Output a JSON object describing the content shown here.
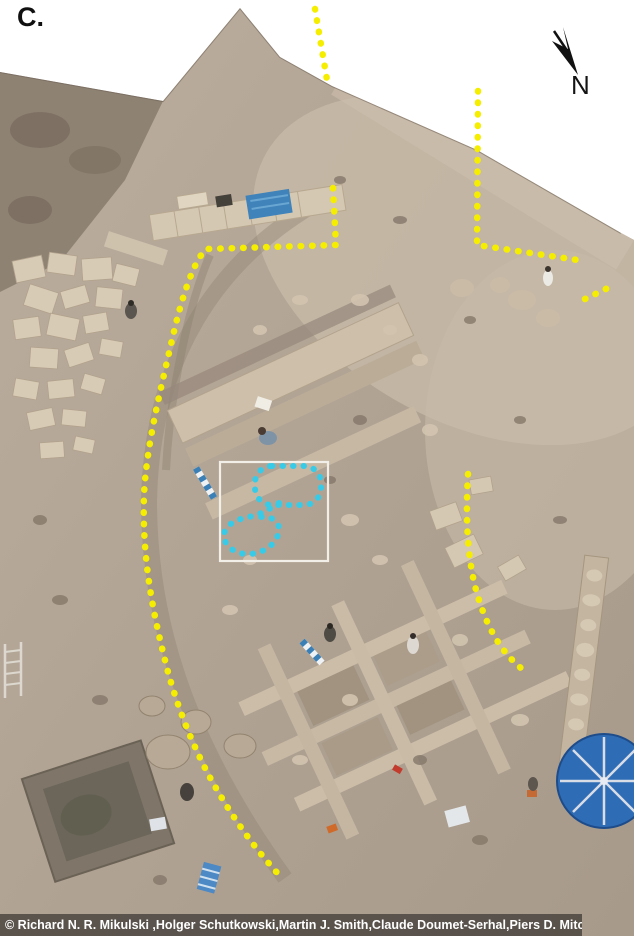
{
  "figure": {
    "panel_label": "C.",
    "compass": {
      "label": "N"
    }
  },
  "annotations": {
    "yellow": "#f6ee00",
    "cyan": "#38cbe8",
    "box": "#f2efe8"
  },
  "credit_bar": {
    "text": "© Richard N. R. Mikulski ,Holger Schutkowski,Martin J. Smith,Claude Doumet-Serhal,Piers D. Mitchell"
  }
}
